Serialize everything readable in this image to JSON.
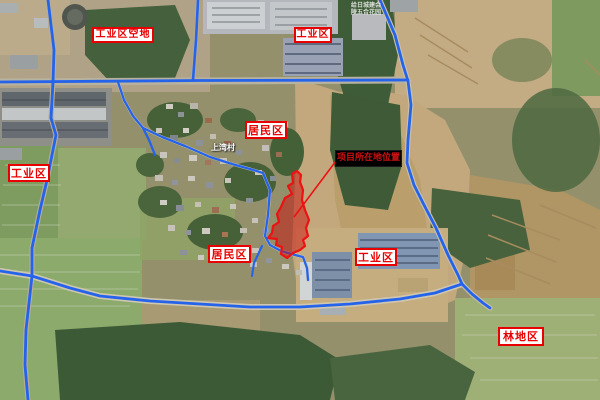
{
  "map": {
    "colors": {
      "road_annotation": "#2563eb",
      "site_outline": "#ee1111",
      "site_fill": "#cc0000",
      "leader_line": "#ee1111",
      "label_text": "#e80000",
      "label_border": "#e80000",
      "label_background": "#ffffff",
      "dark_label_background": "#000000",
      "dark_label_text": "#cc1111"
    },
    "region_labels": {
      "industrial_vacant": "工业区空地",
      "industrial_top": "工业区",
      "industrial_left": "工业区",
      "residential_top": "居民区",
      "residential_bottom": "居民区",
      "industrial_bottom": "工业区",
      "forest": "林地区",
      "project_site": "项目所在地位置"
    },
    "poi_labels": {
      "village": "上湾村",
      "tiny_line1": "给日城建会",
      "tiny_line2": "陵五合花园"
    }
  }
}
